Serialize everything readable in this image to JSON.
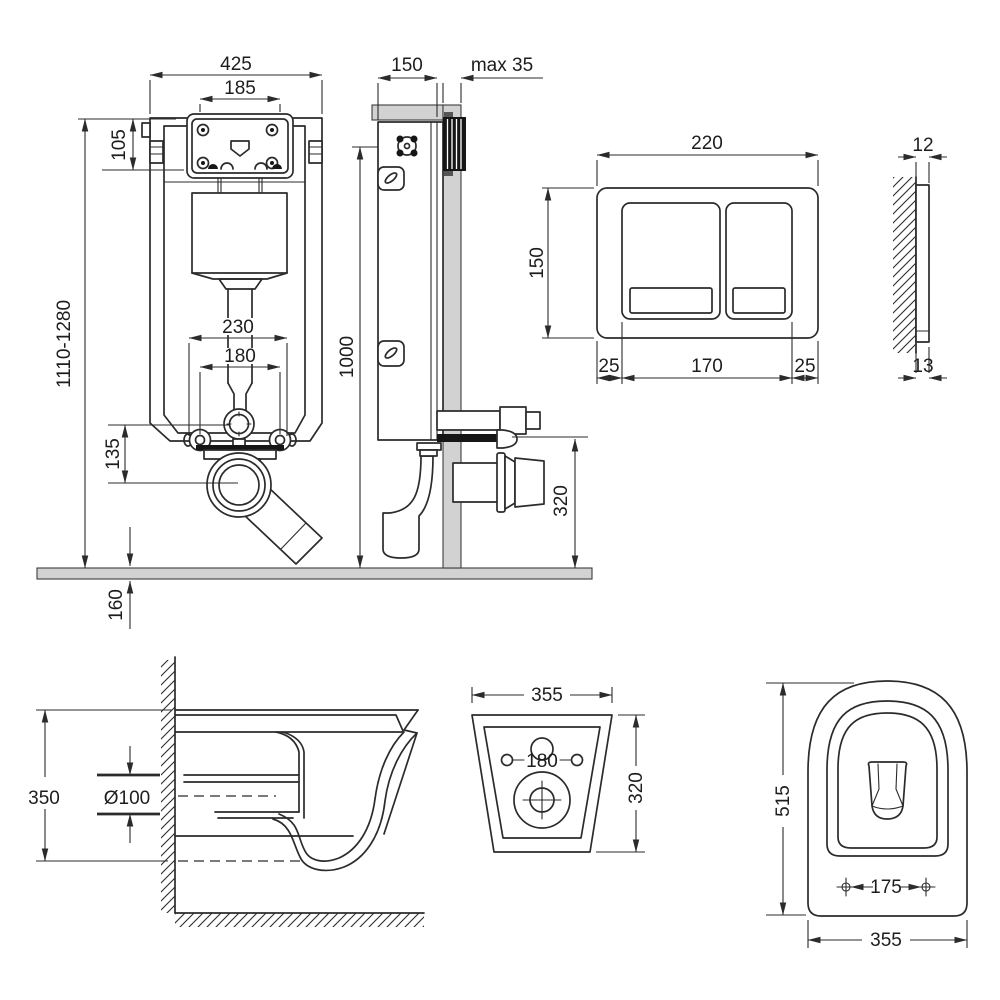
{
  "colors": {
    "background": "#ffffff",
    "line": "#2b2b2b",
    "wall_fill": "#d2d2d2"
  },
  "views": {
    "frame_front": {
      "dims": {
        "frame_width": "425",
        "access_opening_width": "185",
        "access_opening_height": "105",
        "install_height_range": "1110-1280",
        "bracket_outer_width": "230",
        "anchor_spacing": "180",
        "valve_to_drain_offset": "135",
        "floor_buildup": "160"
      }
    },
    "frame_side": {
      "dims": {
        "frame_depth": "150",
        "wall_finish_max": "max 35",
        "frame_height": "1000",
        "outlet_height": "320"
      }
    },
    "flush_plate_front": {
      "dims": {
        "plate_width": "220",
        "plate_height": "150",
        "margin_left": "25",
        "buttons_width": "170",
        "margin_right": "25"
      }
    },
    "flush_plate_side": {
      "dims": {
        "thickness_top": "12",
        "thickness_bottom": "13"
      }
    },
    "bowl_side": {
      "dims": {
        "bowl_height": "350",
        "outlet_diameter": "Ø100"
      }
    },
    "bowl_back": {
      "dims": {
        "bowl_width": "355",
        "fixing_holes_spacing": "180",
        "bowl_height": "320"
      }
    },
    "bowl_top": {
      "dims": {
        "bowl_depth": "515",
        "seat_fixing_spacing": "175",
        "bowl_width": "355"
      }
    }
  }
}
